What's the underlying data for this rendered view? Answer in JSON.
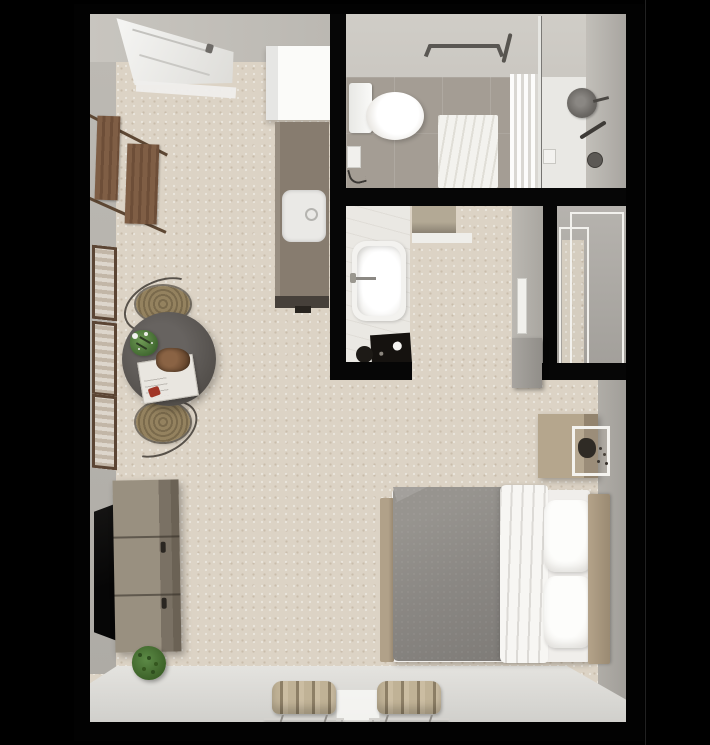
{
  "scene": {
    "title": "studio-apartment-3d-floor-plan",
    "view": "top-down",
    "background_color": "#000000",
    "palette": {
      "outer_walls": "#020202",
      "interior_walls_gray": "#b3b0aa",
      "carpet": "#dcd3c5",
      "bathroom_tile": "#a49d94",
      "lower_floor": "#dcdbd7",
      "counter": "#877c6f",
      "warm_wood": "#7a5942",
      "oak_wood": "#b2a38b",
      "table_top": "#54504c",
      "blanket_gray": "#8a8783",
      "linen_white": "#f7f6f3",
      "plant_green": "#4c7a39",
      "wicker_tan": "#94825f",
      "fixture_metal": "#5a5753"
    },
    "rooms": [
      {
        "name": "entry-kitchen",
        "items": [
          "entry-door",
          "door-threshold",
          "coat-rack",
          "upper-cabinet",
          "kitchen-counter",
          "kitchen-sink"
        ]
      },
      {
        "name": "bathroom",
        "items": [
          "toilet",
          "grab-bar",
          "bath-mat",
          "towel",
          "glass-divider",
          "shower-head",
          "hand-shower",
          "shower-control",
          "toilet-paper-holder"
        ]
      },
      {
        "name": "tub-room",
        "items": [
          "bathtub",
          "tub-faucet",
          "dark-bath-mat",
          "stool",
          "storage-cabinet",
          "door-frame",
          "open-door-leaf"
        ]
      },
      {
        "name": "closet",
        "items": [
          "sliding-door-outer",
          "sliding-door-inner"
        ]
      },
      {
        "name": "living-sleeping-area",
        "items": [
          "gallery-frame-1",
          "gallery-frame-2",
          "gallery-frame-3",
          "dining-table",
          "dining-chair-north",
          "dining-chair-south",
          "table-plant",
          "serving-tray",
          "wall-tv",
          "media-console",
          "floor-plant",
          "bed",
          "gray-blanket",
          "white-duvet",
          "pillow-top",
          "pillow-bottom",
          "headboard",
          "footboard",
          "nightstand",
          "bench-left",
          "bench-right",
          "console-table"
        ]
      }
    ],
    "text_content": []
  }
}
